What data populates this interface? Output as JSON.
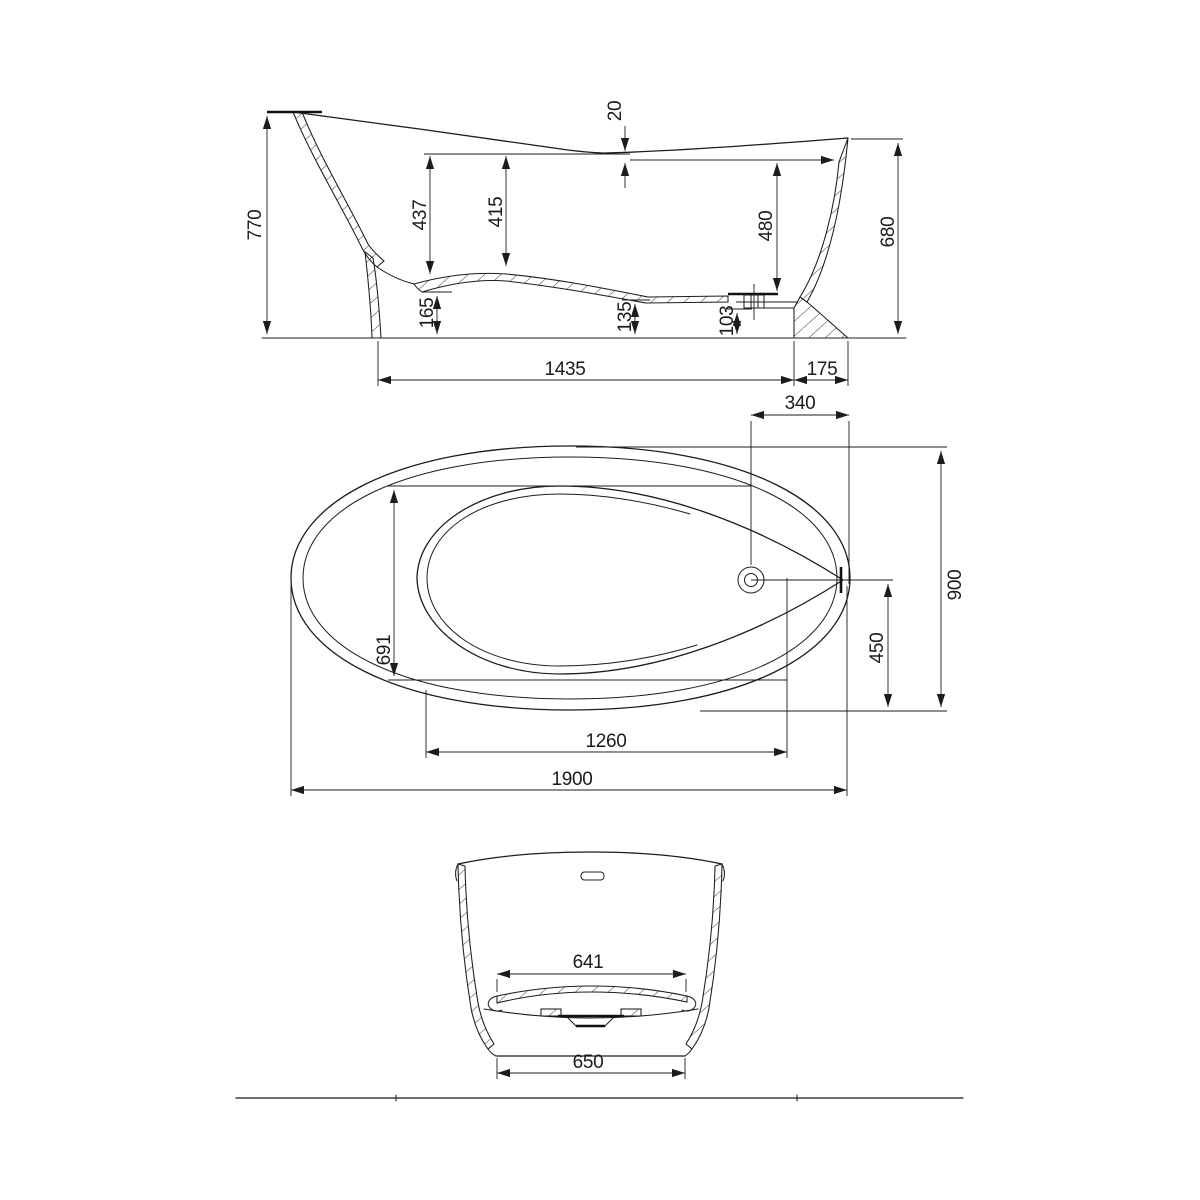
{
  "drawing_type": "bathtub technical drawing, three orthographic views",
  "colors": {
    "line": "#1c1c1c",
    "background": "#ffffff"
  },
  "dims": {
    "side": {
      "overall_height": "770",
      "rim_drop": "20",
      "back_depth": "437",
      "mid_depth": "415",
      "front_depth": "480",
      "front_height": "680",
      "floor_back_height": "165",
      "floor_mid_height": "135",
      "floor_front_height": "103",
      "bottom_length": "1435",
      "bottom_front_length": "175"
    },
    "plan": {
      "drain_offset": "340",
      "overall_width": "900",
      "basin_width": "691",
      "drain_to_side": "450",
      "basin_length": "1260",
      "overall_length": "1900"
    },
    "end": {
      "floor_width": "641",
      "base_width": "650"
    }
  }
}
